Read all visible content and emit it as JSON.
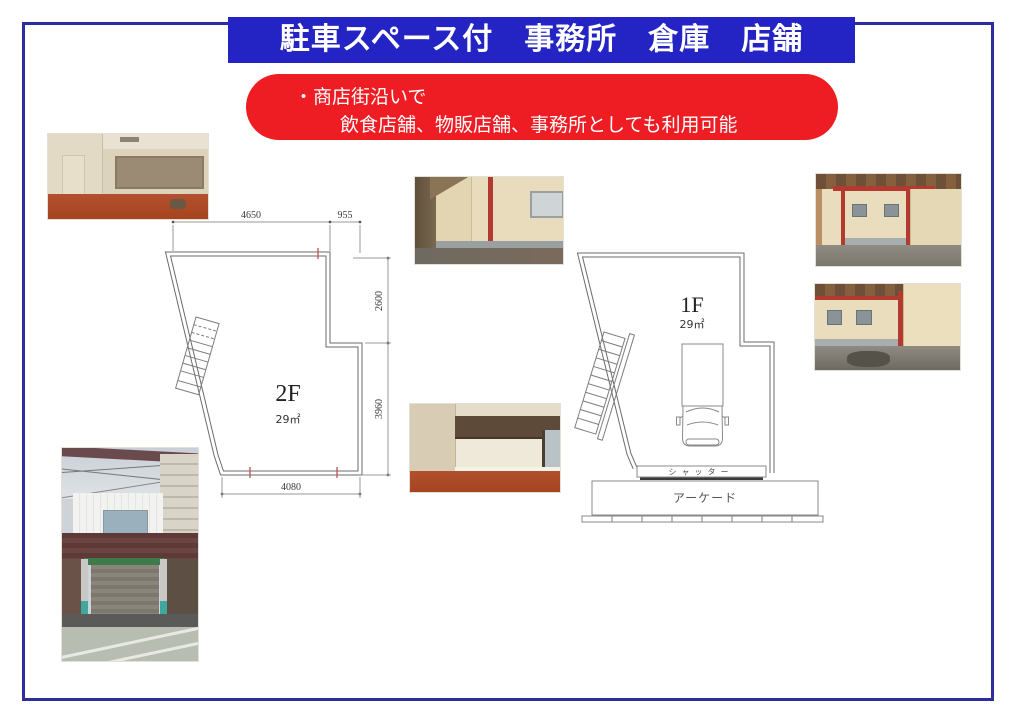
{
  "page": {
    "title": "駐車スペース付　事務所　倉庫　店舗",
    "notice_line1": "・商店街沿いで",
    "notice_line2": "飲食店舗、物販店舗、事務所としても利用可能",
    "colors": {
      "banner_blue": "#2424c4",
      "border_blue": "#2d2d9e",
      "notice_red": "#ee1c23"
    }
  },
  "floorplan_2f": {
    "label": "2F",
    "area": "29㎡",
    "dims": {
      "top_left": "4650",
      "top_right": "955",
      "right_upper": "2600",
      "right_lower": "3960",
      "bottom": "4080"
    }
  },
  "floorplan_1f": {
    "label": "1F",
    "area": "29㎡",
    "shutter": "シャッター",
    "arcade": "アーケード"
  }
}
